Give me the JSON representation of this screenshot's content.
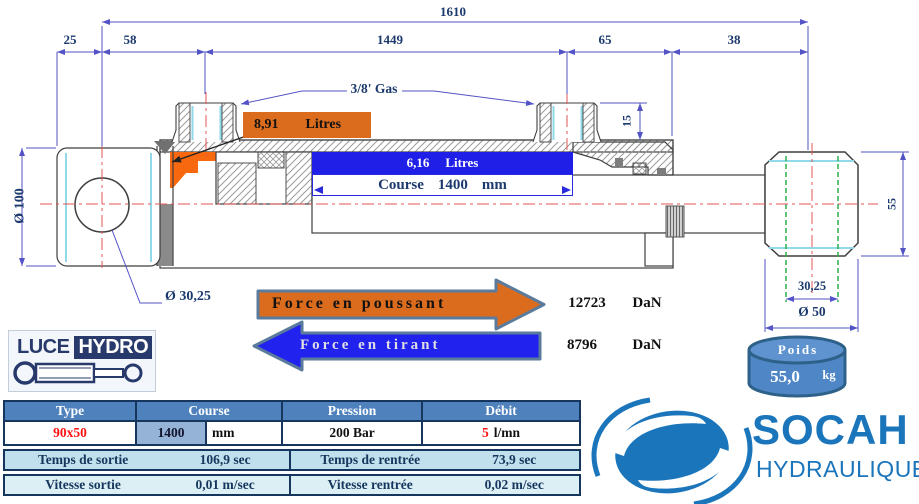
{
  "dimensions": {
    "total": "1610",
    "d25": "25",
    "d58": "58",
    "d1449": "1449",
    "d65": "65",
    "d38": "38",
    "d15": "15",
    "dia100": "Ø 100",
    "dia3025": "Ø 30,25",
    "d55": "55",
    "d3025": "30,25",
    "dia50": "Ø 50"
  },
  "annotations": {
    "port": "3/8' Gas",
    "push_volume": {
      "value": "8,91",
      "unit": "Litres"
    },
    "pull_volume": {
      "value": "6,16",
      "unit": "Litres"
    },
    "course": {
      "label": "Course",
      "value": "1400",
      "unit": "mm"
    }
  },
  "forces": {
    "push": {
      "label": "Force en poussant",
      "value": "12723",
      "unit": "DaN"
    },
    "pull": {
      "label": "Force en tirant",
      "value": "8796",
      "unit": "DaN"
    }
  },
  "weight": {
    "label": "Poids",
    "value": "55,0",
    "unit": "kg"
  },
  "logos": {
    "luce": {
      "part1": "LUCE",
      "part2": "HYDRO"
    },
    "socah": {
      "name": "SOCAH",
      "sub": "HYDRAULIQUE"
    }
  },
  "table": {
    "headers": {
      "type": "Type",
      "course": "Course",
      "pression": "Pression",
      "debit": "Débit"
    },
    "values": {
      "type": "90x50",
      "course": "1400",
      "course_unit": "mm",
      "pression": "200 Bar",
      "debit": "5",
      "debit_unit": "l/mn"
    },
    "rows": [
      {
        "label_left": "Temps de sortie",
        "value_left": "106,9 sec",
        "label_right": "Temps de rentrée",
        "value_right": "73,9 sec"
      },
      {
        "label_left": "Vitesse sortie",
        "value_left": "0,01 m/sec",
        "label_right": "Vitesse rentrée",
        "value_right": "0,02 m/sec"
      }
    ]
  },
  "colors": {
    "orange": "#DC6C1D",
    "blue": "#1F1FE8",
    "navy_text": "#1c3a6e",
    "dim_line": "#5353c6",
    "centerline_red": "#E25555",
    "cyan": "#8FD9E8",
    "green": "#2AB04E",
    "table_header": "#4F81BD",
    "row3": "#BFE0EC",
    "row4": "#DBEFF5",
    "highlight_cell": "#94B3D6",
    "value_red": "#FF1111",
    "socah_blue": "#1B75BB",
    "luce_navy": "#283A6B",
    "steel_border": "#5B7B9D"
  }
}
